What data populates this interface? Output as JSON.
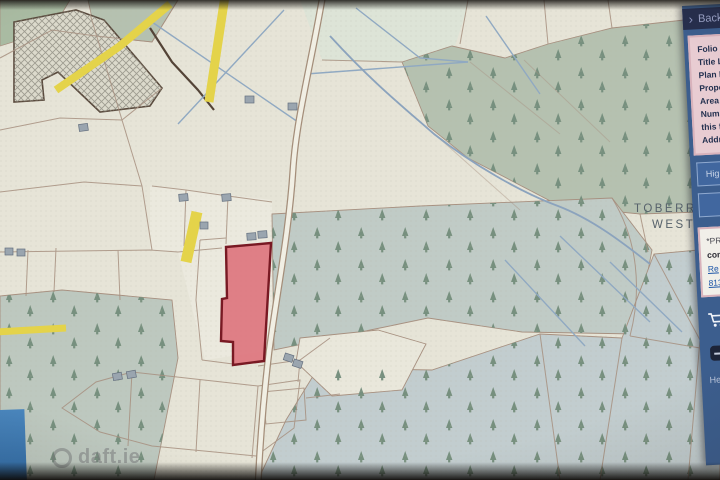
{
  "panel": {
    "back_label": "Back",
    "info_card": {
      "lines": [
        "Folio N",
        "Title Le",
        "Plan N",
        "Prope",
        "Area (",
        "Numb",
        "this f",
        "Addr"
      ]
    },
    "buttons": {
      "highlight_label": "Hig",
      "secondary_label": ""
    },
    "links_card": {
      "line1": "*PR",
      "line2": "con",
      "link1": "Re",
      "link2": "813"
    },
    "help_label": "He"
  },
  "map": {
    "townland_line1": "TOBERROE",
    "townland_line2": "WEST"
  },
  "watermark": {
    "text": "daft.ie"
  },
  "colors": {
    "parcel_highlight_fill": "#e26b75",
    "parcel_highlight_border": "#7c1822",
    "road_yellow": "#e5d343",
    "forest_green": "#b5c1af",
    "forest_blue_green": "#c2cdcf",
    "stream_blue": "#8aa3bf",
    "boundary_brown": "#a8907f",
    "panel_blue": "#3c5e8e",
    "panel_header_navy": "#262e4d",
    "panel_pink": "#e8ccd2"
  }
}
